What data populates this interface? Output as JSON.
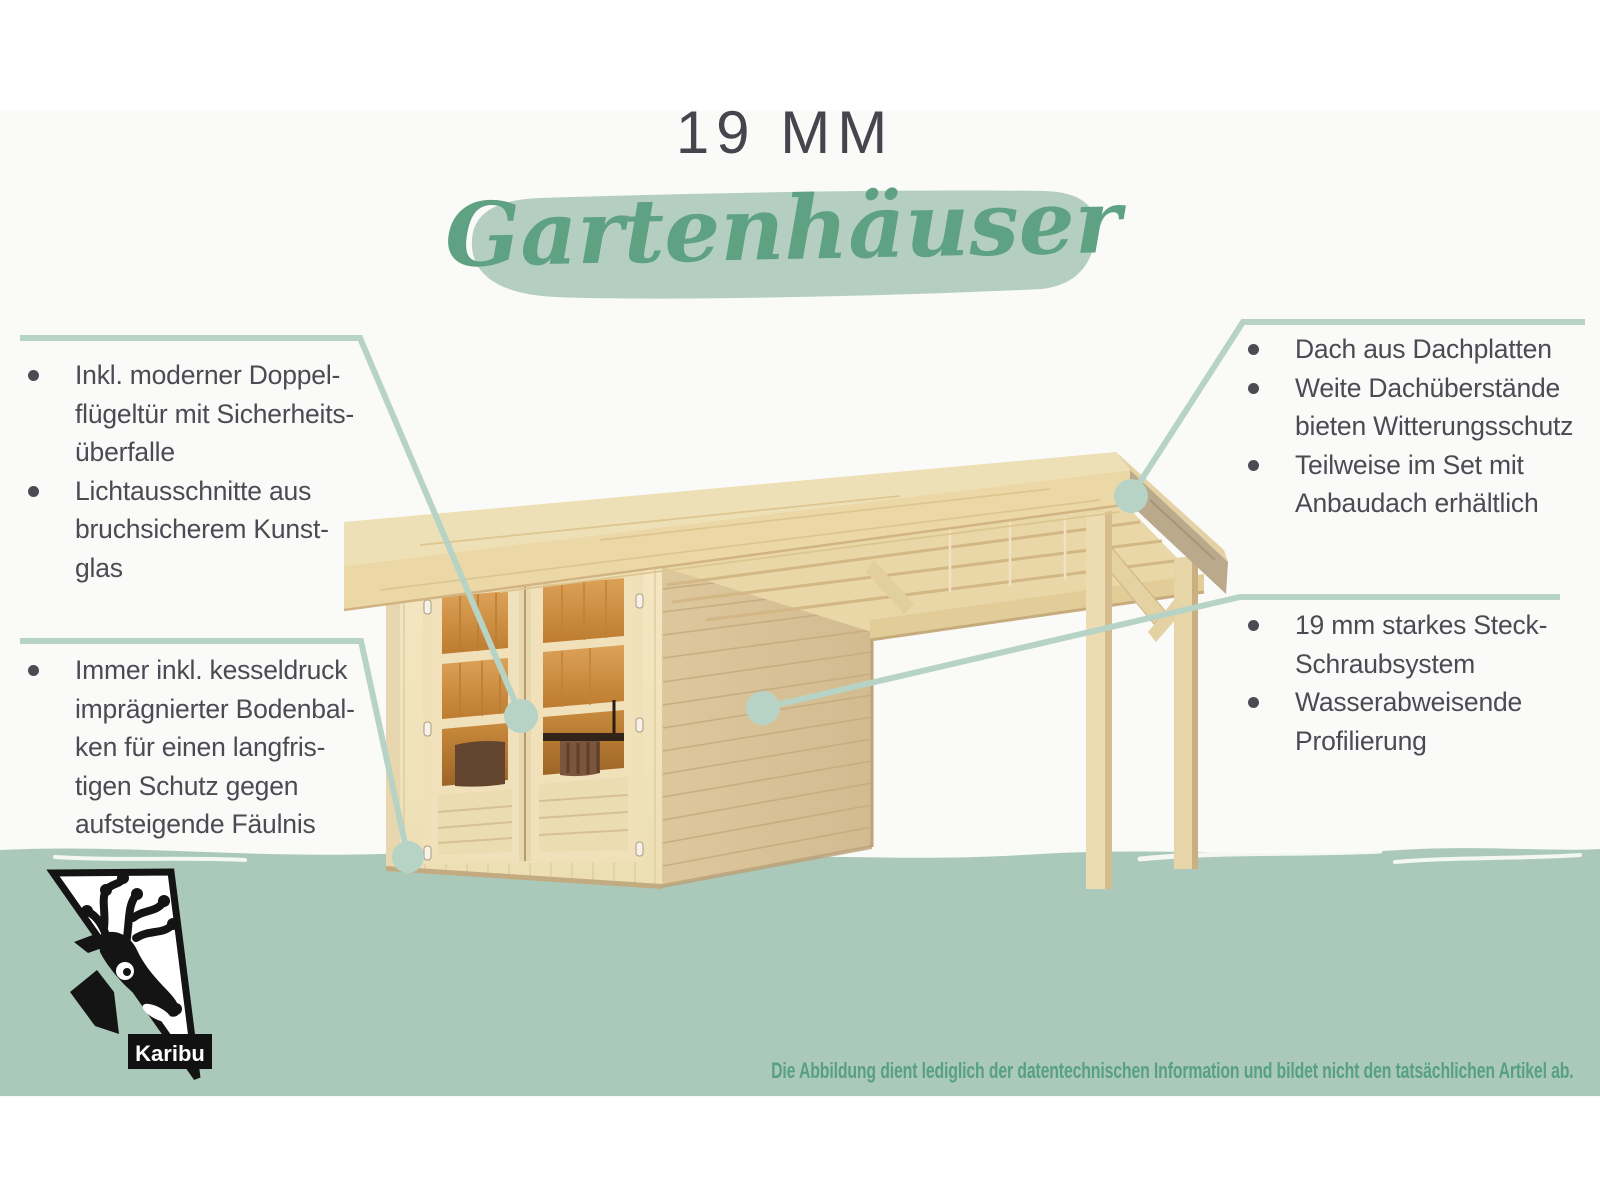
{
  "header": {
    "thickness_label": "19 MM",
    "title": "Gartenhäuser"
  },
  "callouts": {
    "top_left": {
      "items": [
        "Inkl. moderner Doppel-\nflügeltür mit Sicherheits-\nüberfalle",
        "Lichtausschnitte aus\nbruchsicherem Kunst-\nglas"
      ]
    },
    "bottom_left": {
      "items": [
        "Immer inkl. kesseldruck\nimprägnierter Bodenbal-\nken für einen langfris-\ntigen Schutz gegen\naufsteigende Fäulnis"
      ]
    },
    "top_right": {
      "items": [
        "Dach aus Dachplatten",
        "Weite Dachüberstände\nbieten Witterungsschutz",
        "Teilweise im Set mit\nAnbaudach erhältlich"
      ]
    },
    "middle_right": {
      "items": [
        "19 mm starkes Steck-\nSchraubsystem",
        "Wasserabweisende\nProfilierung"
      ]
    }
  },
  "footer": {
    "disclaimer": "Die Abbildung dient lediglich der datentechnischen Information und bildet nicht den tatsächlichen Artikel ab."
  },
  "logo": {
    "brand": "Karibu"
  },
  "colors": {
    "accent_green": "#5fa183",
    "callout_line": "#b7d3c5",
    "band": "#abc9ba",
    "brush": "#b4cfc1",
    "text_dark": "#4b4b54",
    "wood_light": "#f1e2bb",
    "wood_shade": "#d9c299",
    "glass_orange": "#cd8f41"
  }
}
